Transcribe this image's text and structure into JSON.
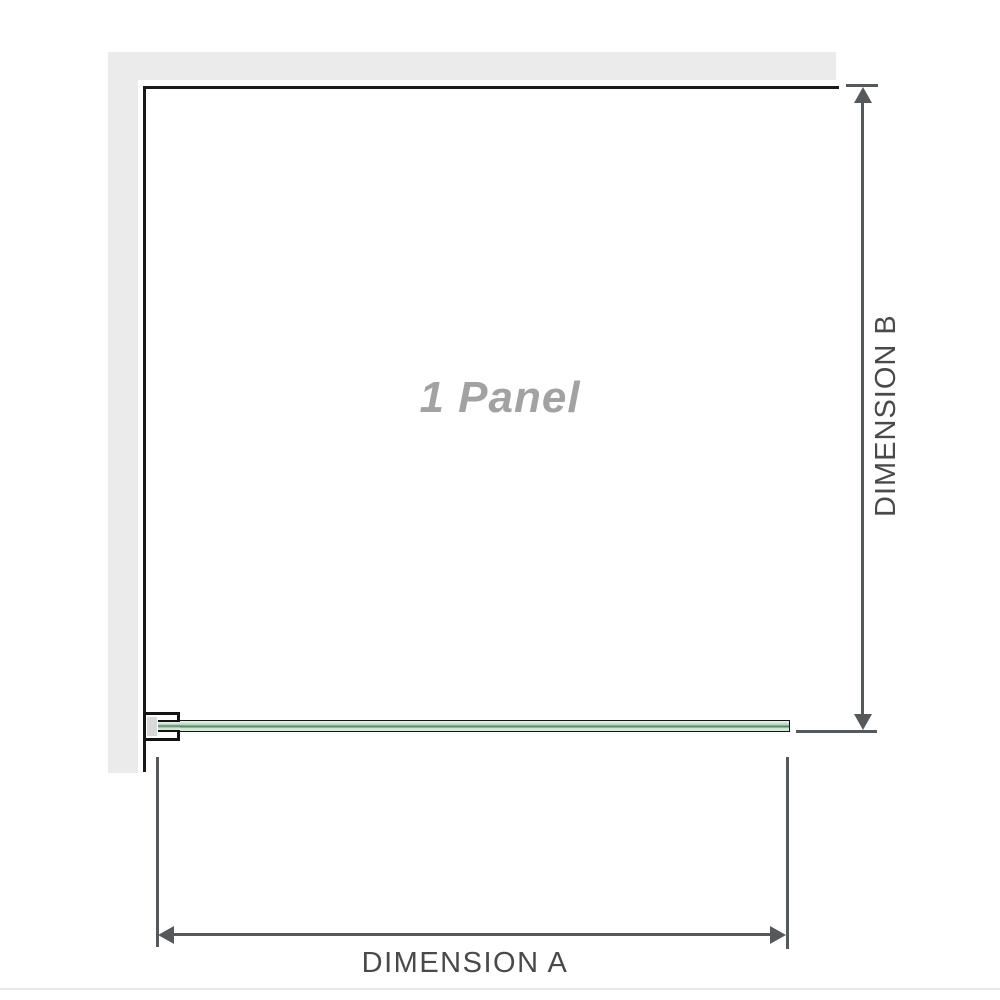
{
  "diagram": {
    "panel_label": "1 Panel",
    "dimensions": {
      "a_label": "DIMENSION A",
      "b_label": "DIMENSION B"
    },
    "colors": {
      "wall_fill": "#ebebeb",
      "edge_line": "#1a1a1a",
      "dimension_line": "#55595c",
      "dimension_text": "#4a4a4a",
      "panel_text": "#a2a2a2",
      "glass_light": "#d8ecdc",
      "glass_mid": "#9fcfad",
      "glass_dark": "#5c7c64",
      "bracket_fill": "#ffffff",
      "bracket_block": "#d8d8d8"
    }
  }
}
